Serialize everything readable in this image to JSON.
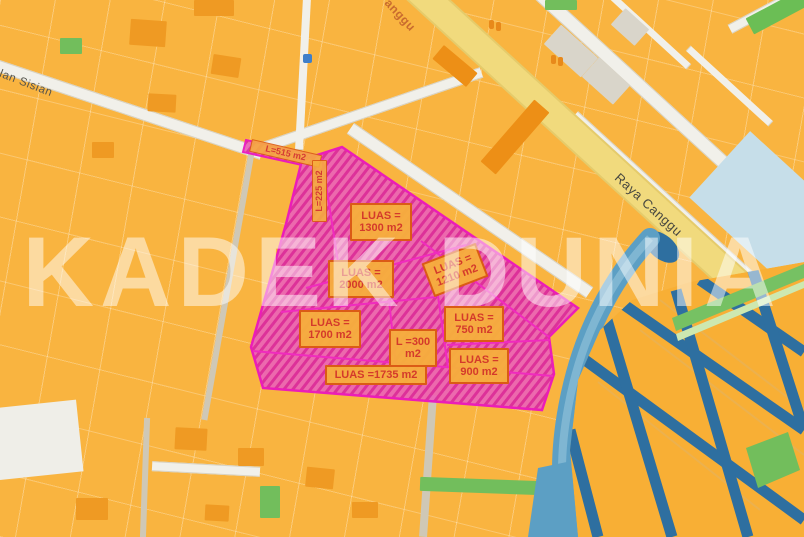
{
  "map": {
    "watermark": "KADEK DUNIA",
    "road_labels": {
      "raya_canggu": "Raya Canggu",
      "sisian": "lan Sisian",
      "canggu_partial": "anggu"
    },
    "parcel_labels": [
      {
        "text": "L=515 m2"
      },
      {
        "text": "L=225 m2"
      },
      {
        "text": "LUAS =\n1300 m2"
      },
      {
        "text": "LUAS =\n2000 m2"
      },
      {
        "text": "LUAS =\n1210 m2"
      },
      {
        "text": "LUAS =\n1700 m2"
      },
      {
        "text": "L =300\nm2"
      },
      {
        "text": "LUAS =\n750 m2"
      },
      {
        "text": "LUAS =\n900 m2"
      },
      {
        "text": "LUAS =1735 m2"
      }
    ],
    "colors": {
      "parcel_base": "#F9B440",
      "highlight_fill": "#EC64B6",
      "highlight_hatch": "#DB28A0",
      "highlight_border": "#EA12C2",
      "label_bg": "#F6AE3C",
      "label_border": "#DB5B16",
      "label_text": "#D43A2B",
      "road_yellow": "#F1DA7D",
      "river_blue": "#5C9FC4",
      "canal_blue": "#2E6FA0",
      "green": "#72BE5C"
    }
  }
}
